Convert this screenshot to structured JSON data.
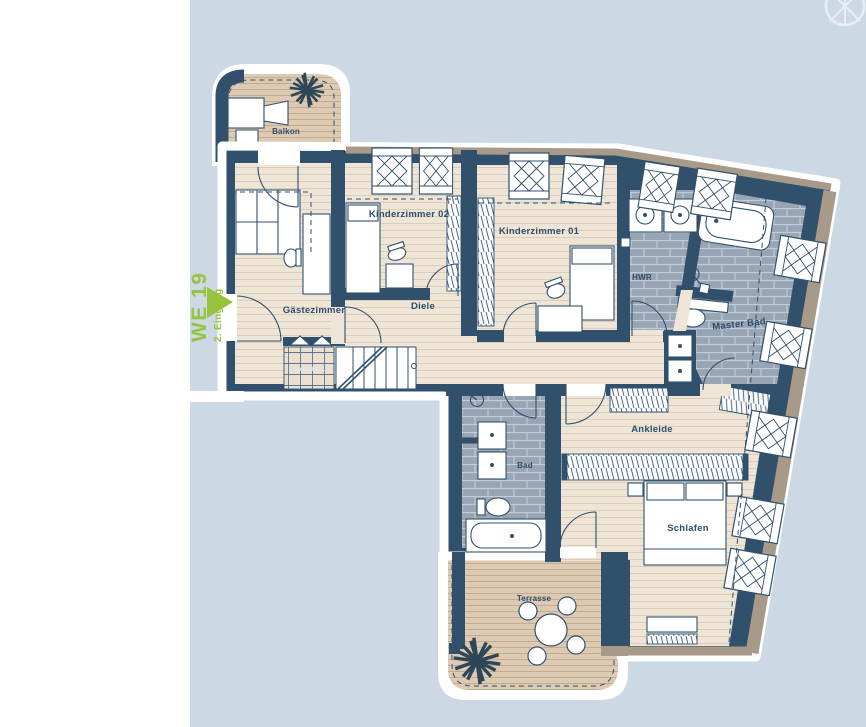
{
  "side_label": {
    "unit": "WE 19",
    "entrance": "2. Eingang"
  },
  "rooms": {
    "balkon": "Balkon",
    "gaestezimmer": "Gästezimmer",
    "kinderzimmer02": "Kinderzimmer 02",
    "kinderzimmer01": "Kinderzimmer 01",
    "diele": "Diele",
    "hwr": "HWR",
    "master_bad": "Master Bad",
    "abstell": "Abstell 01",
    "bad": "Bad",
    "ankleide": "Ankleide",
    "schlafen": "Schlafen",
    "terrasse": "Terrasse"
  },
  "icons": {
    "compass": "compass-rose-icon",
    "entrance_arrow": "entrance-arrow-icon",
    "plant": "plant-icon"
  },
  "colors": {
    "background_blue": "#ccd8e3",
    "page_margin": "#ffffff",
    "wall_navy": "#31506c",
    "wood_floor": "#eee5d7",
    "deck_wood": "#dccab2",
    "bath_tile": "#98a5b5",
    "insulation_tan": "#a89a89",
    "accent_green": "#97c33e"
  }
}
